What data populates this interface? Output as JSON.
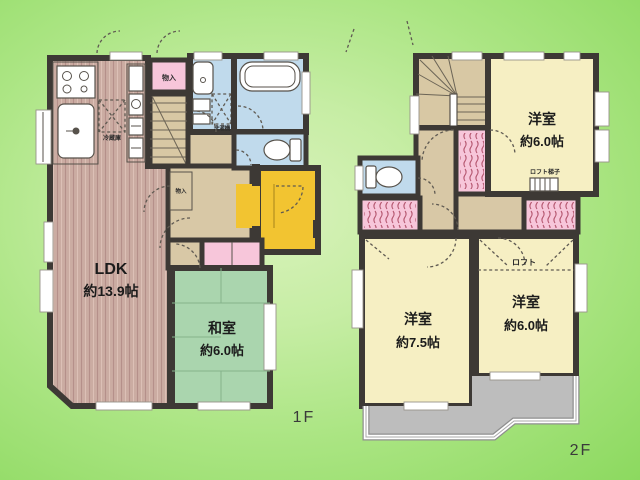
{
  "floor1": {
    "label": "1F",
    "ldk": {
      "name": "LDK",
      "size": "約13.9帖"
    },
    "washitsu": {
      "name": "和室",
      "size": "約6.0帖"
    },
    "closet_top": "物入",
    "closet_hall": "物入",
    "refrigerator": "冷蔵庫",
    "washer": "洗濯機"
  },
  "floor2": {
    "label": "2F",
    "bedroom_top": {
      "name": "洋室",
      "size": "約6.0帖"
    },
    "bedroom_left": {
      "name": "洋室",
      "size": "約7.5帖"
    },
    "bedroom_right": {
      "name": "洋室",
      "size": "約6.0帖"
    },
    "loft": "ロフト",
    "loft_ladder": "ロフト梯子"
  },
  "colors": {
    "background_light": "#d9f2bb",
    "background_dark": "#8cd95f",
    "wall": "#3d3935",
    "wood_floor": "#cbaca2",
    "tatami": "#aad5ae",
    "fixture_blue": "#c0daec",
    "closet_pink": "#f7c6da",
    "entrance_yellow": "#f2c431",
    "bedroom_yellow": "#f6efc3",
    "hall_tan": "#d8c8a6",
    "stairs_beige": "#d8c8a4",
    "balcony_gray": "#bdbdbd"
  }
}
